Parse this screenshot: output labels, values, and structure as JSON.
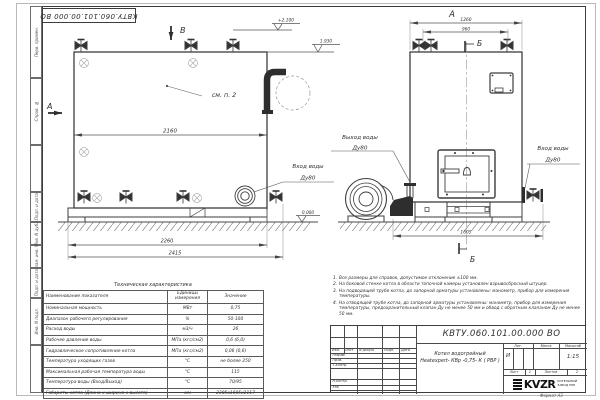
{
  "doc": {
    "stamp_number": "КВТУ.060.101.00.000  ВО"
  },
  "margin": {
    "labels": [
      "Перв. примен.",
      "Справ. №",
      "Подп. и дата",
      "Инв. N дубл.",
      "Взам. инв. N",
      "Подп. и дата",
      "Инв. N подл."
    ]
  },
  "side_view": {
    "section_b": "В",
    "section_a": "А",
    "see_note": "см. п. 2",
    "elev_top": "+2.100",
    "elev_mid": "1.930",
    "elev_zero": "0.000",
    "dim_body": "2160",
    "dim_base": "2260",
    "dim_overall": "2415",
    "inlet_line1": "Вход воды",
    "inlet_line2": "Ду80"
  },
  "front_view": {
    "view_label": "А",
    "section_mark_top": "Б",
    "section_mark_bottom": "Б",
    "dim_overall": "1260",
    "dim_valves": "960",
    "dim_width": "1605",
    "outlet_line1": "Выход воды",
    "outlet_line2": "Ду80",
    "inlet_line1": "Вход воды",
    "inlet_line2": "Ду80"
  },
  "tech_table": {
    "title": "Техническая характеристика",
    "col_name": "Наименование показателя",
    "col_units": "Единицы измерения",
    "col_value": "Значение",
    "rows": [
      {
        "name": "Номинальная мощность",
        "units": "МВт",
        "value": "0,75"
      },
      {
        "name": "Диапазон рабочего регулирования",
        "units": "%",
        "value": "50-100"
      },
      {
        "name": "Расход воды",
        "units": "м3/ч",
        "value": "26"
      },
      {
        "name": "Рабочее давление воды",
        "units": "МПа (кгс/см2)",
        "value": "0,6 (6,0)"
      },
      {
        "name": "Гидравлическое сопротивление котла",
        "units": "МПа (кгс/см2)",
        "value": "0,06 (0,6)"
      },
      {
        "name": "Температура уходящих газов",
        "units": "°С",
        "value": "не более 250"
      },
      {
        "name": "Максимальная рабочая температура воды",
        "units": "°С",
        "value": "115"
      },
      {
        "name": "Температура воды (Вход/Выход)",
        "units": "°С",
        "value": "70/95"
      },
      {
        "name": "Габариты котла (Длина х ширина х высота)",
        "units": "мм",
        "value": "2385х1605х2117"
      }
    ]
  },
  "notes": {
    "items": [
      {
        "num": "1.",
        "text": "Все размеры для справок, допустимое отклонение ±100 мм."
      },
      {
        "num": "2.",
        "text": "На боковой стенке котла в области топочной камеры установлен взрывосбросный штуцер."
      },
      {
        "num": "3.",
        "text": "На  подводящей трубе котла, до запорной арматуры установлены: манометр, прибор для измерения температуры."
      },
      {
        "num": "4.",
        "text": "На отводящей трубе котла, до запорной арматуры установлены: манометр, прибор для измерения температуры, предохранительный клапан Ду не менее 50 мм и обвод с обратным клапаном Ду не менее 50 мм."
      }
    ]
  },
  "title_block": {
    "number": "КВТУ.060.101.00.000  ВО",
    "name_line1": "Котел водогрейный",
    "name_line2": "Heatexpert- КВр -0,75- К ( РВР )",
    "col_izm": "Изм.",
    "col_list": "Лист",
    "col_doc": "N докум.",
    "col_podp": "Подп.",
    "col_data": "Дата",
    "row_razrab": "Разраб.",
    "row_prov": "Пров.",
    "row_tkontr": "Т.контр.",
    "row_nkontr": "Н.контр.",
    "row_utv": "Утв.",
    "lit_label": "Лит.",
    "mass_label": "Масса",
    "scale_label": "Масштаб",
    "lit_value": "И",
    "scale_value": "1:15",
    "sheet_label": "Лист",
    "sheet_num": "1",
    "sheets_label": "Листов",
    "sheets_num": "2",
    "logo_text": "KVZR",
    "logo_sub1": "КОТЕЛЬНЫЙ",
    "logo_sub2": "ЗАВОД РЭП",
    "format_label": "Формат  А3"
  }
}
